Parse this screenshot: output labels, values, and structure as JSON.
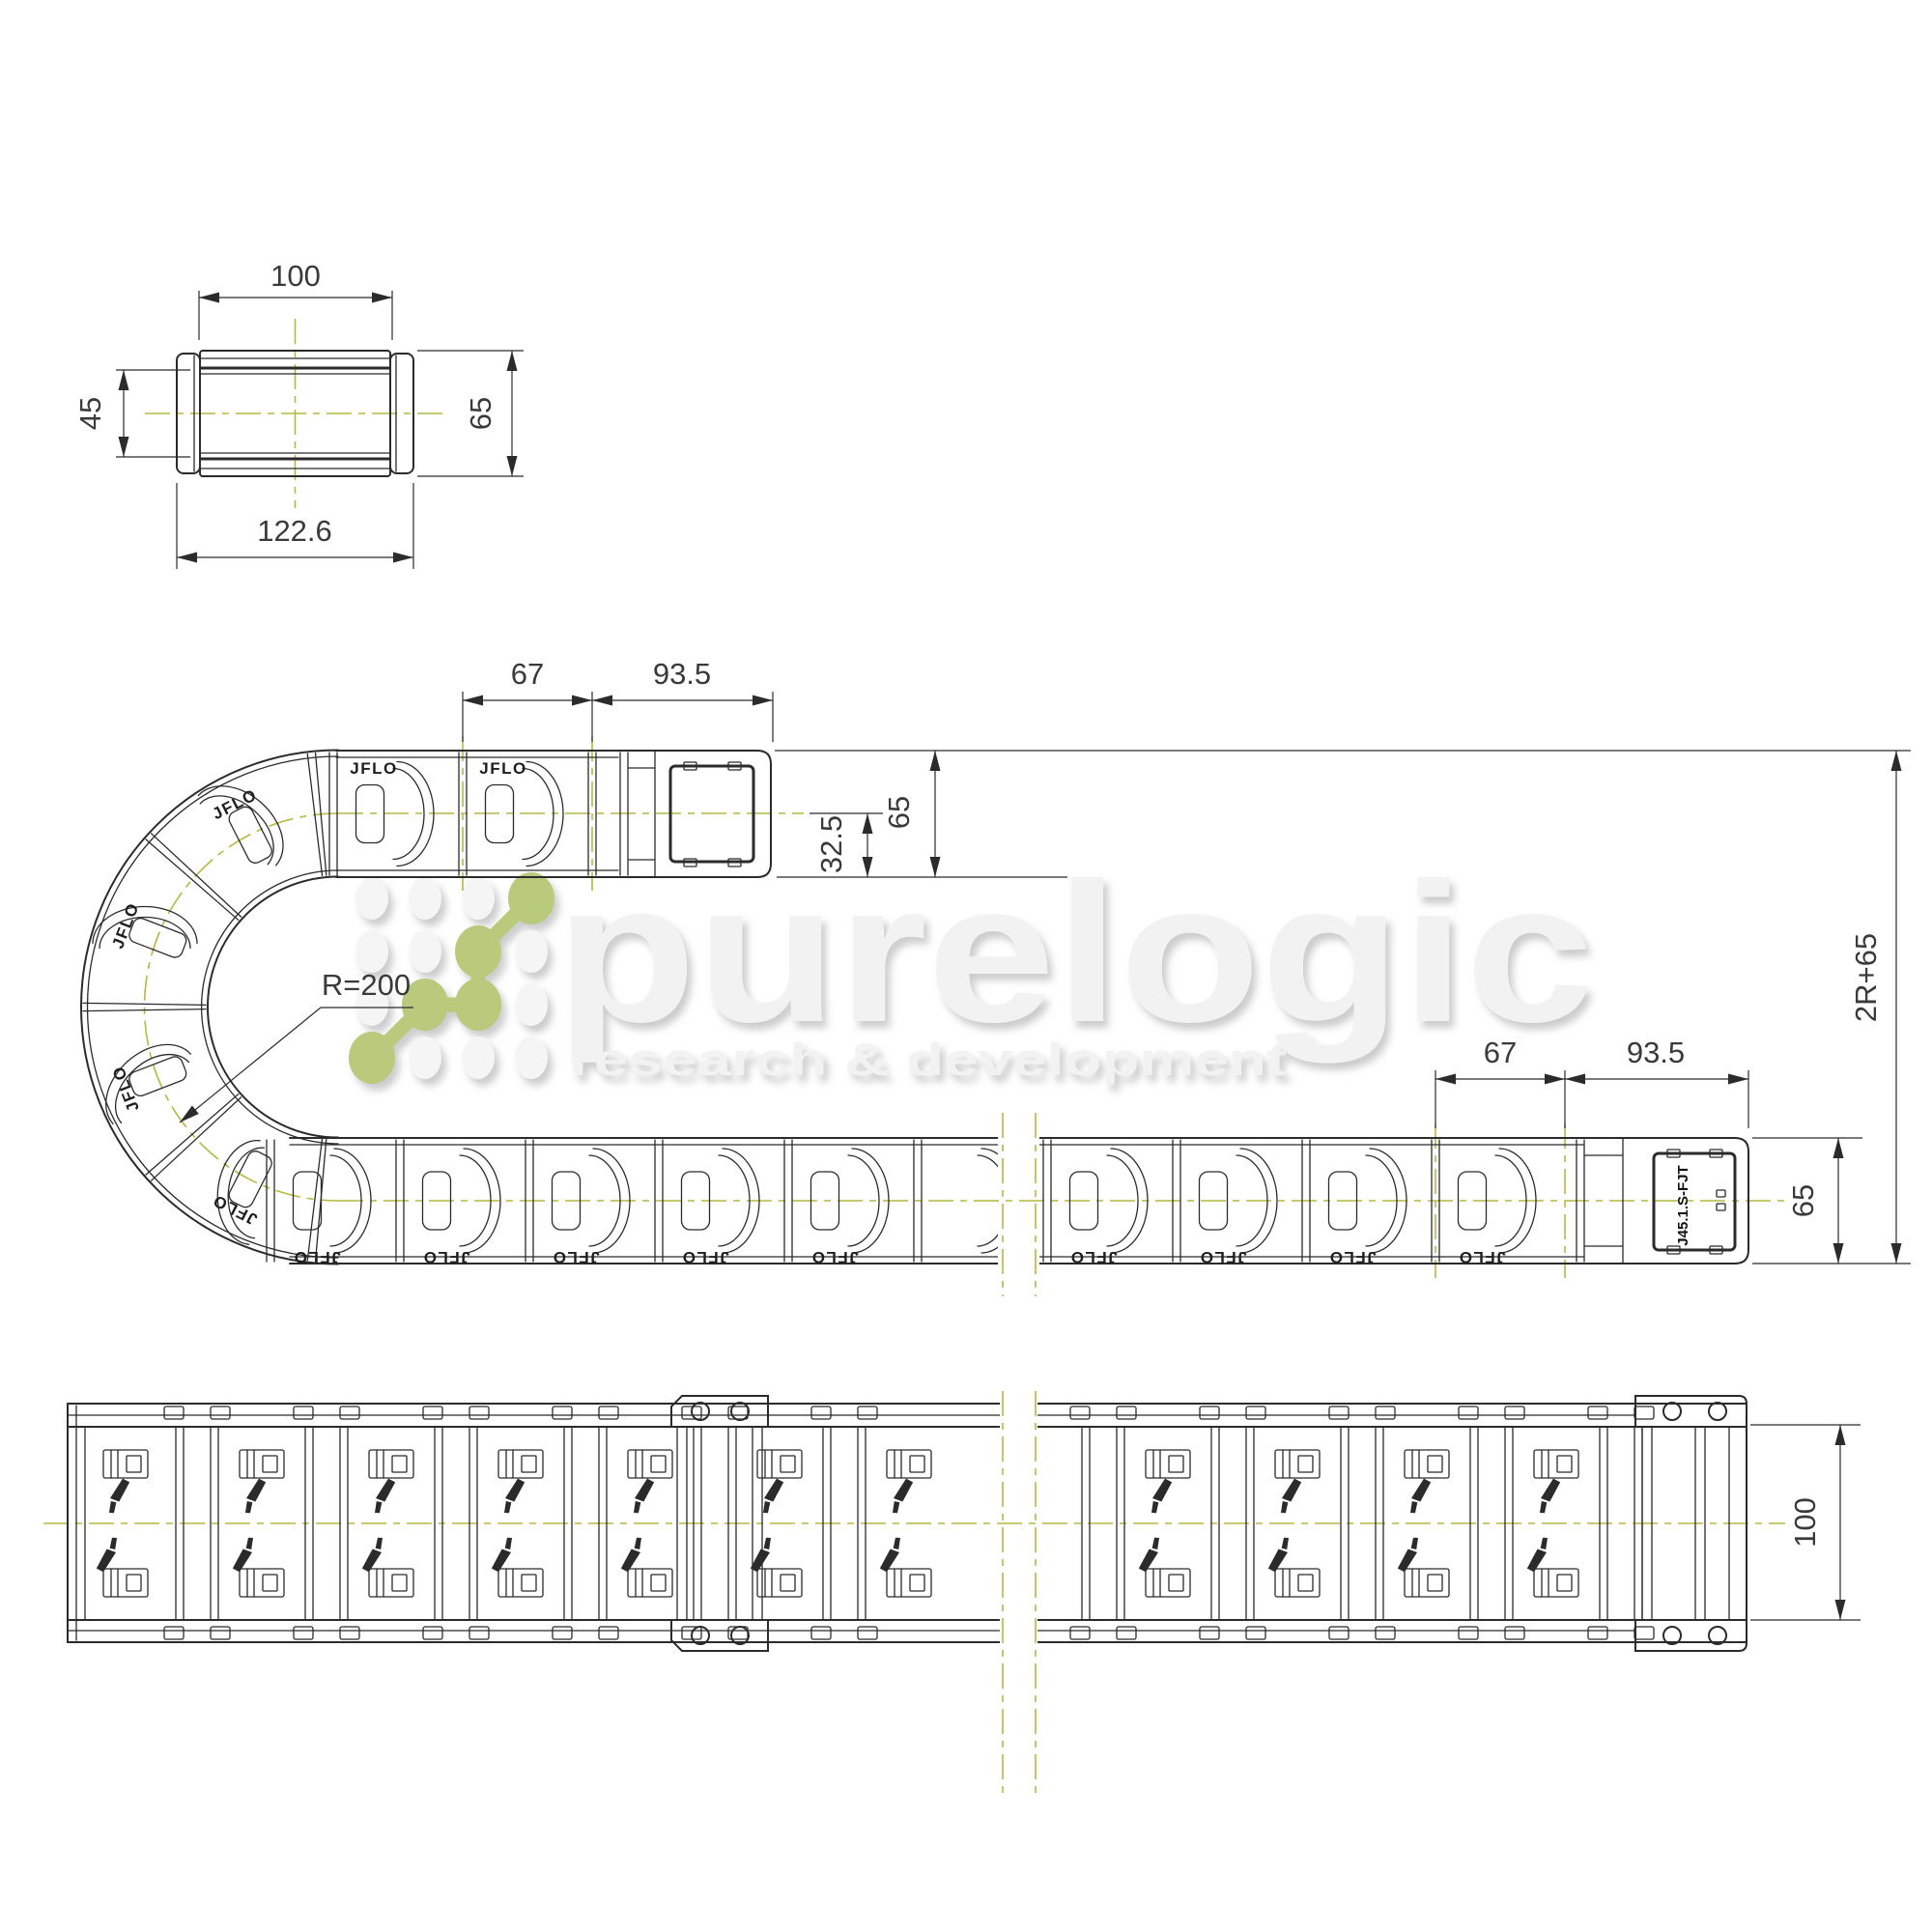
{
  "brand": "JFLO",
  "connector_label": "J45.1.S-FJT",
  "watermark": {
    "title": "purelogic",
    "subtitle": "research & development"
  },
  "dims": {
    "sec_top": "100",
    "sec_left": "45",
    "sec_right": "65",
    "sec_bottom": "122.6",
    "up_pitch": "67",
    "up_end": "93.5",
    "up_height": "65",
    "up_half": "32.5",
    "bend_radius": "R=200",
    "total_height": "2R+65",
    "low_pitch": "67",
    "low_end": "93.5",
    "low_height": "65",
    "top_width": "100"
  },
  "colors": {
    "line": "#2b2b2b",
    "centerline": "#b5b942",
    "accent_green": "#b9ca7d",
    "watermark_gray": "#f2f2f2",
    "dim_text": "#3a3a3a"
  }
}
